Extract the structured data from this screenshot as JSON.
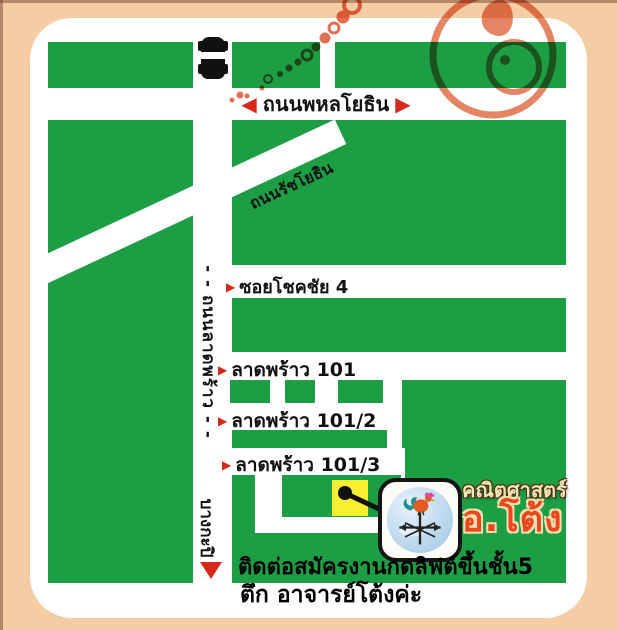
{
  "colors": {
    "background_peach": "#f5cda5",
    "map_white": "#ffffff",
    "block_green": "#1d9e45",
    "arrow_red": "#d6281c",
    "swirl_orange": "#e0714a",
    "marker_yellow": "#f7ef2f",
    "logo_school_cream": "#f2e4bc",
    "logo_name_red": "#e8481c"
  },
  "roads": {
    "phahonyothin": "ถนนพหลโยธิน",
    "ratchayothin": "ถนนรัชโยธิน",
    "chokchai4": "ซอยโชคชัย 4",
    "latphrao101": "ลาดพร้าว 101",
    "latphrao101_2": "ลาดพร้าว 101/2",
    "latphrao101_3": "ลาดพร้าว 101/3",
    "latphrao_vertical": "- - ถนนลาดพร้าว - -",
    "bangkapi": "บางกะปิ"
  },
  "arrows": {
    "left": "◀",
    "right": "▶",
    "small_right": "▶"
  },
  "logo": {
    "school": "คณิตศาสตร์",
    "name": "อ.โต้ง"
  },
  "note": {
    "line1": "ติดต่อสมัครงานกดลิฟต์ขึ้นชั้น5",
    "line2": "ตึก อาจารย์โต้งค่ะ"
  },
  "icons": {
    "car": "car-top-view-icon",
    "rooster": "rooster-weathervane-icon",
    "marker": "building-location-marker",
    "swirl": "decorative-swirl"
  }
}
